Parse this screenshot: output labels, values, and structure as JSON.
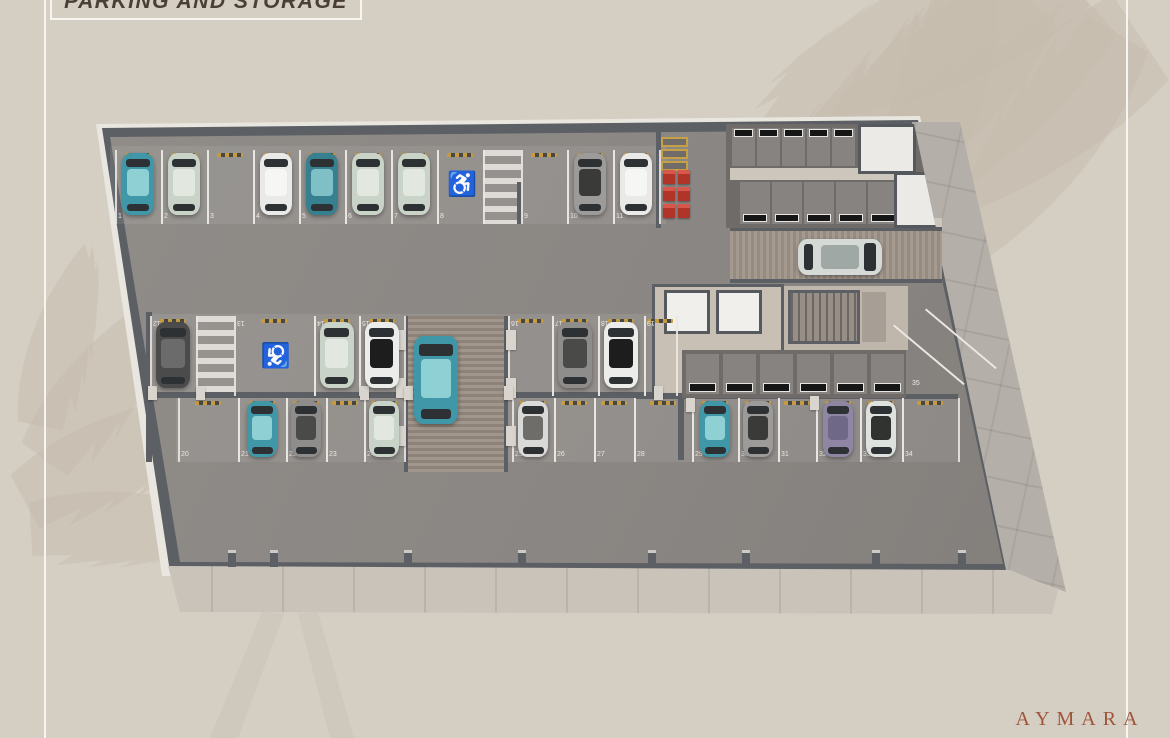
{
  "page": {
    "title": "PARKING AND STORAGE",
    "brand": "AYMARA",
    "background_color": "#d5cec3",
    "title_color": "#493f33",
    "brand_color": "#a0543a"
  },
  "plan": {
    "handicap_symbol": "♿",
    "handicap_color": "#2d87a3",
    "rows": [
      {
        "name": "top-row",
        "spots": [
          {
            "num": "1",
            "car": "teal"
          },
          {
            "num": "2",
            "car": "sage"
          },
          {
            "num": "3",
            "car": null
          },
          {
            "num": "4",
            "car": "white"
          },
          {
            "num": "5",
            "car": "teal-dark"
          },
          {
            "num": "6",
            "car": "sage"
          },
          {
            "num": "7",
            "car": "sage"
          },
          {
            "num": "8",
            "car": null,
            "handicap": true
          },
          {
            "num": "9",
            "car": null
          },
          {
            "num": "10",
            "car": "gray-suv"
          },
          {
            "num": "11",
            "car": "white"
          }
        ]
      },
      {
        "name": "island-upper-row",
        "spots": [
          {
            "num": "12",
            "car": "dark-gray"
          },
          {
            "num": "13",
            "car": null,
            "handicap": true
          },
          {
            "num": "14",
            "car": "sage"
          },
          {
            "num": "15",
            "car": "white-black"
          },
          {
            "num": "16",
            "car": null
          },
          {
            "num": "17",
            "car": "gray-van"
          },
          {
            "num": "18",
            "car": "white-black"
          },
          {
            "num": "19",
            "car": null
          }
        ]
      },
      {
        "name": "island-lower-row",
        "spots": [
          {
            "num": "20",
            "car": null
          },
          {
            "num": "21",
            "car": "teal"
          },
          {
            "num": "22",
            "car": "gray-van"
          },
          {
            "num": "23",
            "car": null
          },
          {
            "num": "24",
            "car": "sage"
          },
          {
            "num": "25",
            "car": "truck"
          },
          {
            "num": "26",
            "car": null
          },
          {
            "num": "27",
            "car": null
          },
          {
            "num": "28",
            "car": null
          },
          {
            "num": "29",
            "car": "teal"
          },
          {
            "num": "30",
            "car": "gray-suv"
          },
          {
            "num": "31",
            "car": null
          },
          {
            "num": "32",
            "car": "purple"
          },
          {
            "num": "33",
            "car": "white-suv"
          },
          {
            "num": "34",
            "car": null
          }
        ]
      },
      {
        "name": "angled-spot",
        "spots": [
          {
            "num": "35",
            "car": null
          }
        ]
      }
    ],
    "moving_cars": [
      {
        "location": "entry-ramp",
        "car": "silver"
      },
      {
        "location": "central-ramp",
        "car": "teal"
      }
    ],
    "storage": {
      "top_block_upper_units": 5,
      "top_block_lower_units": 5,
      "center_units": 6
    },
    "equipment": {
      "electrical_panels": 3,
      "red_boxes": 6
    },
    "core": {
      "elevators": 2
    }
  },
  "palette": {
    "teal": {
      "body": "#3f97a8",
      "roof": "#8fd0d4"
    },
    "teal-dark": {
      "body": "#37808f",
      "roof": "#7fbfc6"
    },
    "sage": {
      "body": "#c9d3c8",
      "roof": "#e2e8e0"
    },
    "white": {
      "body": "#e9e9e7",
      "roof": "#f6f6f4"
    },
    "white-black": {
      "body": "#ececea",
      "roof": "#1d1d1d"
    },
    "dark-gray": {
      "body": "#4b4b4b",
      "roof": "#6b6b6b"
    },
    "gray-van": {
      "body": "#8e8d8b",
      "roof": "#4a4a48"
    },
    "gray-suv": {
      "body": "#9c9b99",
      "roof": "#3a3a38"
    },
    "purple": {
      "body": "#8f86a4",
      "roof": "#6f6886"
    },
    "white-suv": {
      "body": "#dde2de",
      "roof": "#30332f"
    },
    "truck": {
      "body": "#d9d9d7",
      "roof": "#6e6d69"
    },
    "silver": {
      "body": "#d5dad7",
      "roof": "#9fa8a4"
    }
  }
}
